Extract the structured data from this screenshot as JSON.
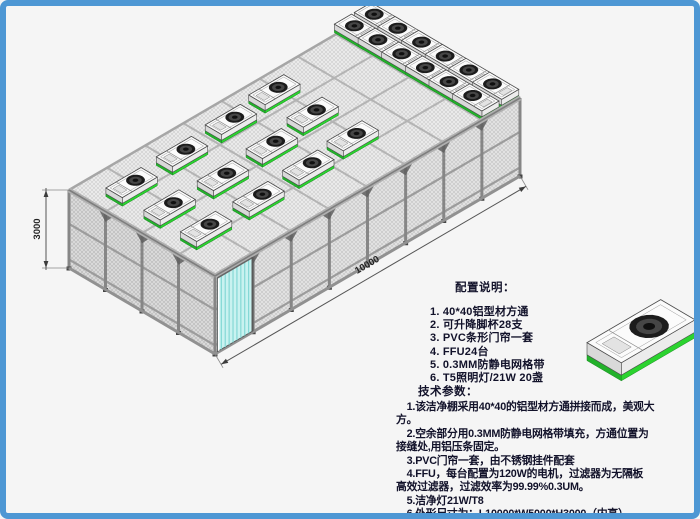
{
  "frame": {
    "border_color": "#4e97d4",
    "background": "#f5f5f5"
  },
  "drawing": {
    "height_dim_label": "3000",
    "length_dim_label": "10000",
    "ffu_unit_count": 24,
    "colors": {
      "ffu_green": "#2bd32f",
      "ffu_green_dark": "#22b12a",
      "door_cyan": "#c9f2f0",
      "door_stripe": "#84d8d5",
      "mesh_wall": "#e4e4e4",
      "mesh_left": "#dcdcdc",
      "mesh_roof": "#ededed",
      "frame_gray": "#8a8a8a",
      "fan_dark": "#1c1c1c"
    },
    "ffu_scattered_positions_mm": [
      [
        1000,
        1350
      ],
      [
        1000,
        2600
      ],
      [
        1000,
        3900
      ],
      [
        2700,
        1330
      ],
      [
        2700,
        2550
      ],
      [
        2700,
        3950
      ],
      [
        4400,
        1400
      ],
      [
        4400,
        2650
      ],
      [
        4400,
        4050
      ],
      [
        5950,
        1500
      ],
      [
        5950,
        2870
      ],
      [
        5950,
        4180
      ]
    ],
    "ffu_cluster": {
      "row_l_positions_mm": [
        9050,
        9700
      ],
      "w_positions_mm": [
        520,
        1330,
        2140,
        2950,
        3760,
        4570
      ]
    },
    "door_span_mm": [
      80,
      1230
    ]
  },
  "config_notes": {
    "title": "配置说明：",
    "items": [
      "1. 40*40铝型材方通",
      "2. 可升降脚杯28支",
      "3. PVC条形门帘一套",
      "4. FFU24台",
      "5. 0.3MM防静电网格带",
      "6. T5照明灯/21W 20盏"
    ]
  },
  "tech_params": {
    "title": "技术参数：",
    "lines": [
      "　1.该洁净棚采用40*40的铝型材方通拼接而成，美观大",
      "方。",
      "　2.空余部分用0.3MM防静电网格带填充，方通位置为",
      "接缝处,用铝压条固定。",
      "　3.PVC门帘一套，由不锈钢挂件配套",
      "　4.FFU，每台配置为120W的电机，过滤器为无隔板",
      "高效过滤器，过滤效率为99.99%0.3UM。",
      "　5.洁净灯21W/T8",
      "　6.外形尺寸为：L10000*W5000*H3000（内高）"
    ]
  }
}
